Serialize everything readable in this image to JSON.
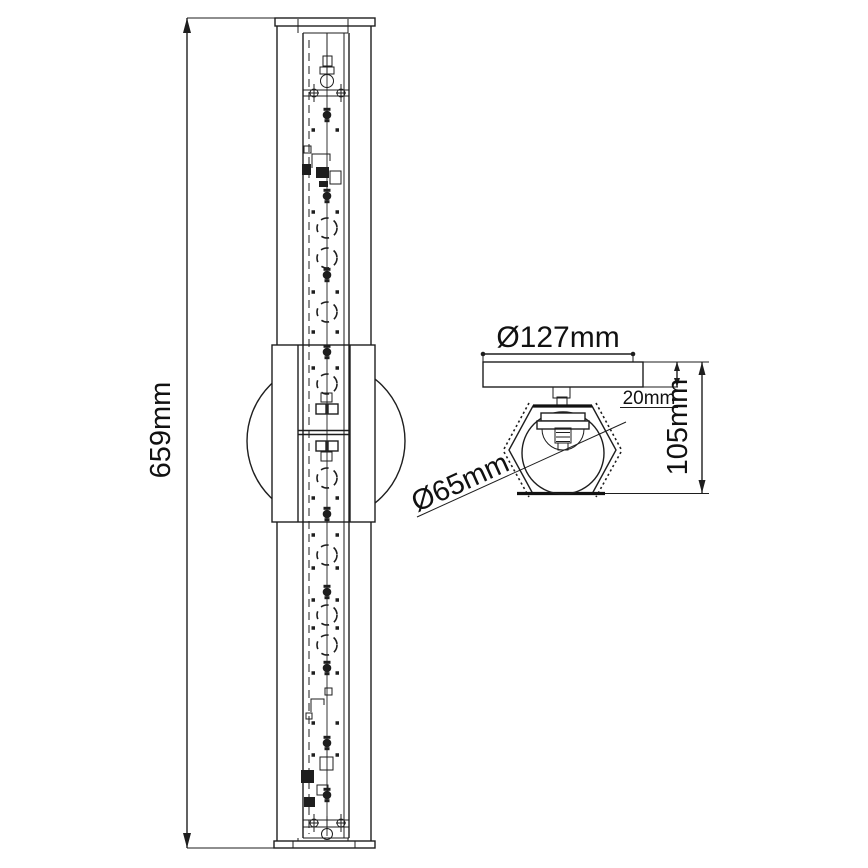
{
  "drawing": {
    "labels": {
      "height": "659mm",
      "backplate_diameter": "Ø127mm",
      "backplate_thickness": "20mm",
      "depth": "105mm",
      "shade_diameter": "Ø65mm"
    }
  },
  "colors": {
    "line": "#1e1e1e",
    "background": "#ffffff"
  }
}
